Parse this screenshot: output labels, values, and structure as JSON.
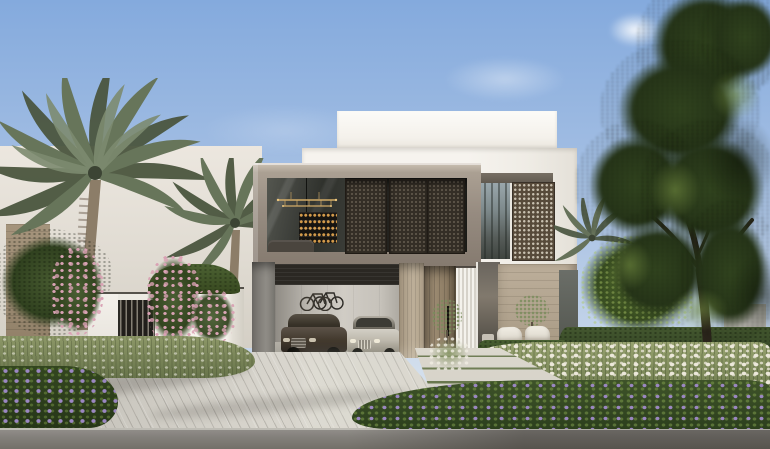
{
  "scene": {
    "type": "architectural-exterior-render",
    "description": "Daytime photorealistic render of a modern two-storey villa: white stacked volumes with a taupe-framed upper floor, bronze geometric mashrabiya screens over glass, an open double garage holding a dark bronze car and a silver car with bicycles mounted on the back wall, a tall wooden pivot entry door between travertine columns, a white boundary wall with a dark slatted gate, date palms and pink flowering shrubs on the left, a large shade tree on the right, white plume grasses and purple ground-cover beds, a grey paver driveway with a stepping-stone walkway, and an asphalt street in the foreground under a soft blue sky",
    "objects": {
      "sky": "clear blue sky with faint wispy clouds",
      "neighbor_villa": "white neighbouring villa with warm stone corner pier, partly hidden by palms",
      "main_villa": {
        "roof_parapet": "white parapet box",
        "upper_floor": "taupe stone frame with glass living-room window, gold linear chandelier, lit bar shelving and three bronze mashrabiya sliding screens",
        "right_wing": "white volume with dark-framed window, bronze screen and travertine-clad base",
        "ground_floor": "open garage with two parked cars and two wall-mounted bicycles, travertine column, tall wooden entry door with black pull handle, fluted sidelight and corner glazing",
        "patio": "two white lounge chairs and a small olive tree in front of the stone wall"
      },
      "garden": {
        "left": "white boundary wall with dark vertical-slat gate, pink flowering shrubs, leafy hedge on the wall top, two date palms",
        "right": "large green shade tree over a clipped hedge, sunlit bush and white plume-grass bed",
        "foreground": "purple-flowering ground-cover beds"
      },
      "hardscape": "light grey paver driveway, stepping-stone entry walkway with grass joints, asphalt road with light curb"
    },
    "palette": {
      "skyTop": "#84aadd",
      "skyMid": "#a9c2e4",
      "skyHorizon": "#d9e2ee",
      "cloud": "#ffffff",
      "wallWhite": "#f6f3ee",
      "frameTaupe": "#968b80",
      "frameTaupeLight": "#aba093",
      "screenBronze": "#574a3a",
      "screenBronzeDark": "#342e26",
      "glassDark": "#3f413c",
      "stoneTravertine": "#bdaf99",
      "woodDoor": "#9a8970",
      "garageCeiling": "#2b2823",
      "carDark": "#41382c",
      "carSilver": "#bdb8ac",
      "foliageDark": "#273619",
      "foliageMid": "#32451f",
      "hedgeGreen": "#44582f",
      "palmFrond": "#67755a",
      "palmFrondDark": "#4b563f",
      "palmTrunk": "#8c7d68",
      "plumeWhite": "#ece8da",
      "pinkBloom": "#d9a2b4",
      "purpleBloom": "#9b87c2",
      "paver": "#ccc9c1",
      "road": "#94918c"
    }
  }
}
